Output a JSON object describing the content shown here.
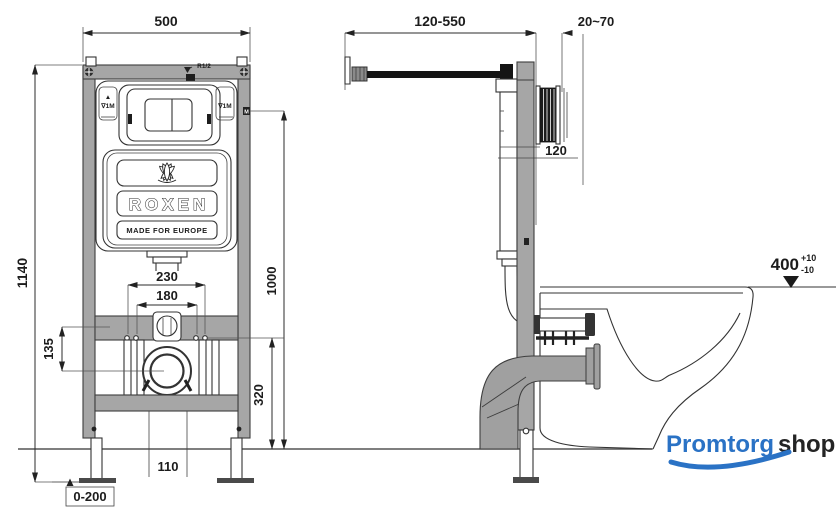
{
  "front_view": {
    "width_top": "500",
    "height_total": "1140",
    "height_level": "1000",
    "thread_label": "R1/2",
    "level_mark_arrow": "▲",
    "level_mark": "∇1M",
    "m_mark": "M",
    "bolt_span_outer": "230",
    "bolt_span_inner": "180",
    "bracket_offset": "135",
    "outlet_height": "320",
    "drain_diameter": "110",
    "feet_range": "0-200",
    "brand": "ROXEN",
    "brand_tagline": "MADE FOR EUROPE"
  },
  "side_view": {
    "supply_range": "120-550",
    "wall_gap": "20~70",
    "depth_label": "120",
    "bowl_height": "400",
    "tol_plus": "+10",
    "tol_minus": "-10"
  },
  "watermark": {
    "text_primary": "Promtorg",
    "text_secondary": "shop",
    "color_primary": "#2a72c5",
    "color_secondary": "#242424"
  }
}
